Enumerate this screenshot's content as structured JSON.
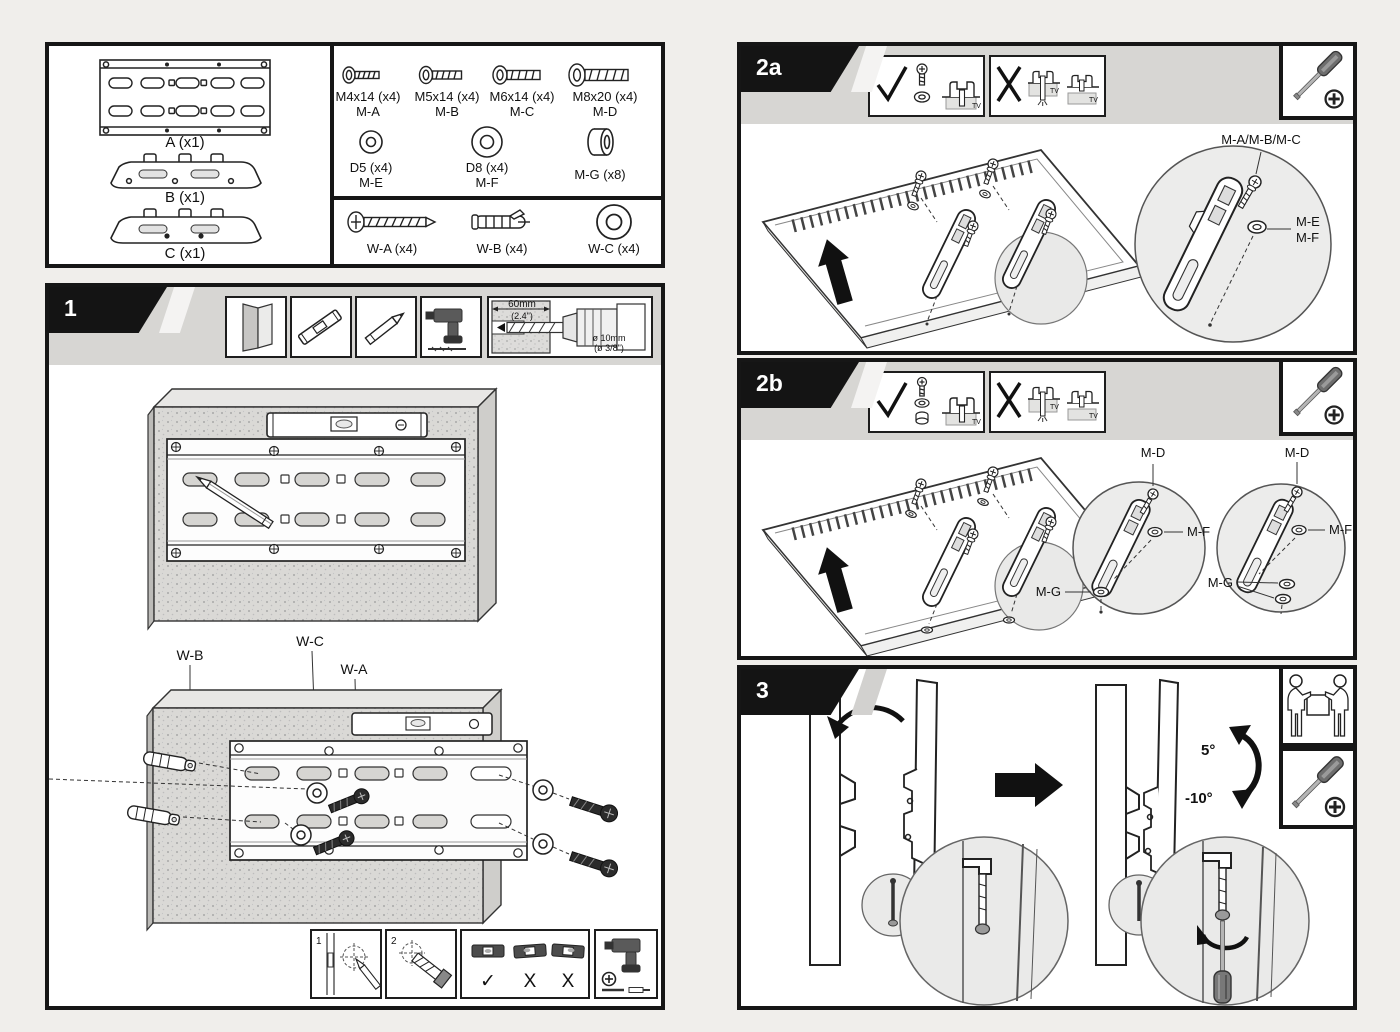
{
  "doc": {
    "tv_label": "TV"
  },
  "parts": {
    "a_label": "A (x1)",
    "b_label": "B (x1)",
    "c_label": "C (x1)",
    "m_screws": [
      {
        "size": "M4x14 (x4)",
        "code": "M-A"
      },
      {
        "size": "M5x14 (x4)",
        "code": "M-B"
      },
      {
        "size": "M6x14 (x4)",
        "code": "M-C"
      },
      {
        "size": "M8x20 (x4)",
        "code": "M-D"
      }
    ],
    "m_washers": [
      {
        "size": "D5 (x4)",
        "code": "M-E"
      },
      {
        "size": "D8 (x4)",
        "code": "M-F"
      }
    ],
    "m_spacer": "M-G (x8)",
    "w_a": "W-A (x4)",
    "w_b": "W-B (x4)",
    "w_c": "W-C (x4)"
  },
  "step1": {
    "num": "1",
    "drill_len": "60mm",
    "drill_len_in": "(2.4\")",
    "drill_dia": "ø 10mm",
    "drill_dia_in": "(ø 3/8\")",
    "wb": "W-B",
    "wc": "W-C",
    "wa": "W-A",
    "sub1": "1",
    "sub2": "2",
    "level_ok": "✓",
    "level_x1": "X",
    "level_x2": "X"
  },
  "step2a": {
    "num": "2a",
    "screws_label": "M-A/M-B/M-C",
    "washer_small": "M-E",
    "washer_big": "M-F"
  },
  "step2b": {
    "num": "2b",
    "screw_label": "M-D",
    "washer_label": "M-F",
    "spacer_label": "M-G"
  },
  "step3": {
    "num": "3",
    "tilt_up": "5°",
    "tilt_down": "-10°"
  }
}
